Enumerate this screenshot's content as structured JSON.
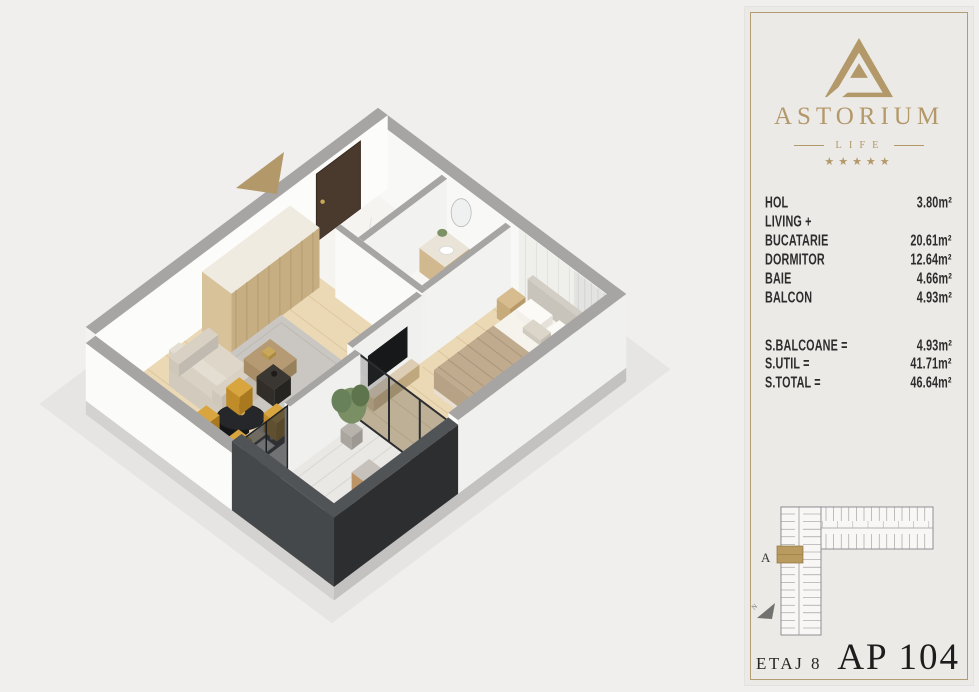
{
  "page": {
    "background_color": "#f0efee"
  },
  "floor_plan": {
    "view": "isometric 3D apartment cutaway render",
    "entrance_arrow_color": "#b3986a",
    "palette": {
      "wall_top": "#a6a5a3",
      "wall_face": "#fafaf9",
      "wood_floor": "#ebd9b6",
      "marble_floor": "#f5f4f1",
      "balcony_wall_dark": "#3c3f42",
      "door_brown": "#4a3a2d",
      "rug_gray": "#cac7c2",
      "chair_yellow": "#d2a03c",
      "wardrobe_wood": "#c6ad82",
      "gold": "#b3986a"
    }
  },
  "panel": {
    "background_color": "#eceae7",
    "border_color": "#b39c72",
    "logo": {
      "brand": "ASTORIUM",
      "sub_brand": "LIFE",
      "stars": "★★★★★",
      "color": "#b3986a"
    },
    "rooms": [
      {
        "label": "HOL",
        "area": "3.80m²"
      },
      {
        "label": "LIVING +",
        "area": ""
      },
      {
        "label": "BUCATARIE",
        "area": "20.61m²"
      },
      {
        "label": "DORMITOR",
        "area": "12.64m²"
      },
      {
        "label": "BAIE",
        "area": "4.66m²"
      },
      {
        "label": "BALCON",
        "area": "4.93m²"
      }
    ],
    "totals": [
      {
        "label": "S.BALCOANE =",
        "area": "4.93m²"
      },
      {
        "label": "S.UTIL =",
        "area": "41.71m²"
      },
      {
        "label": "S.TOTAL =",
        "area": "46.64m²"
      }
    ],
    "site_plan": {
      "wing_label": "A",
      "compass_label": "N",
      "highlight_color": "#b99a5f"
    },
    "floor_label": "ETAJ 8",
    "apartment_label": "AP 104"
  }
}
